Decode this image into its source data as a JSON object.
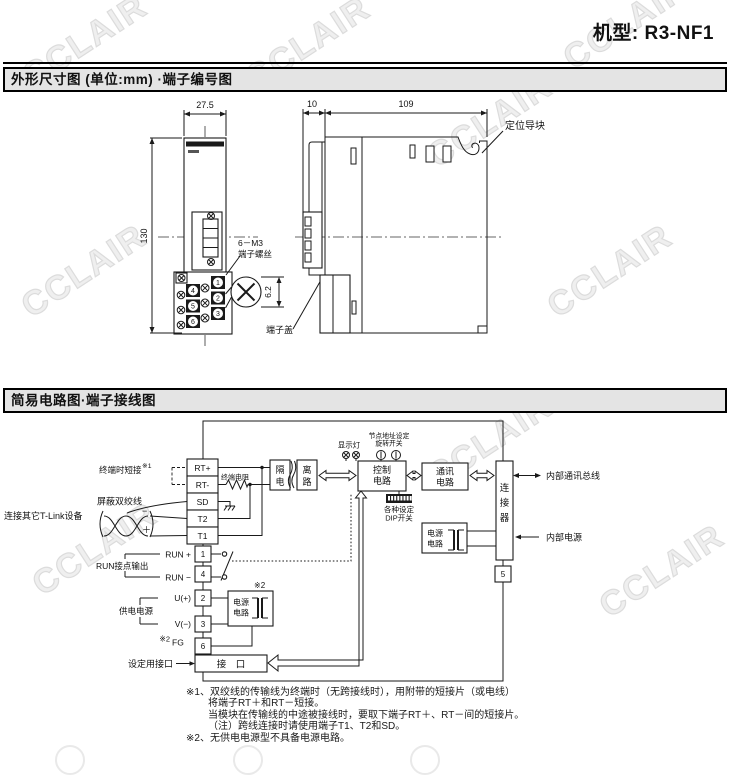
{
  "header": {
    "model": "机型: R3-NF1"
  },
  "watermark": {
    "text": "CCLAIR"
  },
  "section1": {
    "title": "外形尺寸图 (单位:mm) ·端子编号图"
  },
  "section2": {
    "title": "简易电路图·端子接线图"
  },
  "dim": {
    "front_width": "27.5",
    "front_height": "130",
    "terminal_depth": "10",
    "body_depth": "109",
    "screw_pitch": "6.2",
    "screw_label_1": "6－M3",
    "screw_label_2": "端子螺丝",
    "terminal_cover": "端子盖",
    "positioning_guide": "定位导块",
    "n1": "1",
    "n2": "2",
    "n3": "3",
    "n4": "4",
    "n5": "5",
    "n6": "6"
  },
  "ckt": {
    "rt_p": "RT+",
    "rt_m": "RT-",
    "sd": "SD",
    "t2": "T2",
    "t1": "T1",
    "n1": "1",
    "n4": "4",
    "n2": "2",
    "n3": "3",
    "n6": "6",
    "n5": "5",
    "short_label": "终端时短接",
    "ref1": "※1",
    "term_res": "终端电阻",
    "shield": "屏蔽双绞线",
    "tlink": "连接其它T-Link设备",
    "minus": "−",
    "plus": "＋",
    "run_p": "RUN +",
    "run_m": "RUN −",
    "run_out": "RUN接点输出",
    "supply": "供电电源",
    "u": "U(+)",
    "v": "V(−)",
    "ref2": "※2",
    "fg": "FG",
    "set_port": "设定用接口",
    "port": "接　口",
    "iso1": "隔",
    "iso2": "电",
    "iso3": "离",
    "iso4": "路",
    "lamp": "显示灯",
    "rot1": "节点地址设定",
    "rot2": "旋转开关",
    "ctl1": "控制",
    "ctl2": "电路",
    "dip1": "各种设定",
    "dip2": "DIP开关",
    "com1": "通讯",
    "com2": "电路",
    "conn1": "连",
    "conn2": "接",
    "conn3": "器",
    "bus": "内部通讯总线",
    "ipower": "内部电源",
    "pw1": "电源",
    "pw2": "电路"
  },
  "notes": {
    "l1": "※1、双绞线的传输线为终端时（无跨接线时），用附带的短接片（或电线）",
    "l2": "将端子RT＋和RT－短接。",
    "l3": "当模块在传输线的中途被接线时，要取下端子RT＋、RT－间的短接片。",
    "l4": "（注）跨线连接时请使用端子T1、T2和SD。",
    "l5": "※2、无供电电源型不具备电源电路。"
  }
}
